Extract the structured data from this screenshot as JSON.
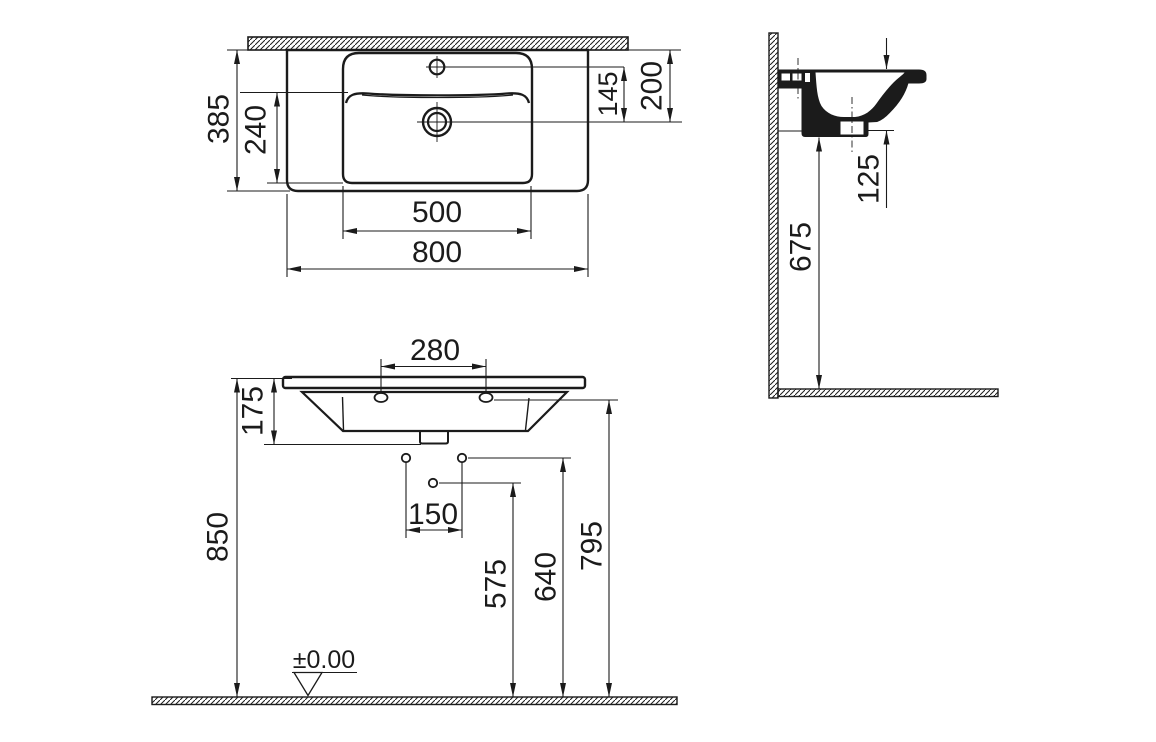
{
  "drawing": {
    "line_color": "#1b1b1b",
    "top_view": {
      "overall_depth": "385",
      "bowl_depth": "240",
      "tap_to_drain": "145",
      "wall_to_drain": "200",
      "bowl_width": "500",
      "overall_width": "800"
    },
    "side_view": {
      "rim_to_outlet": "125",
      "floor_to_underside": "675"
    },
    "front_view": {
      "tap_platform_width": "280",
      "basin_height": "175",
      "floor_to_rim": "850",
      "fixing_hole_spacing": "150",
      "floor_to_drain_hole": "575",
      "floor_to_fixing_holes": "640",
      "floor_to_underside": "795",
      "floor_datum": "±0.00"
    }
  }
}
